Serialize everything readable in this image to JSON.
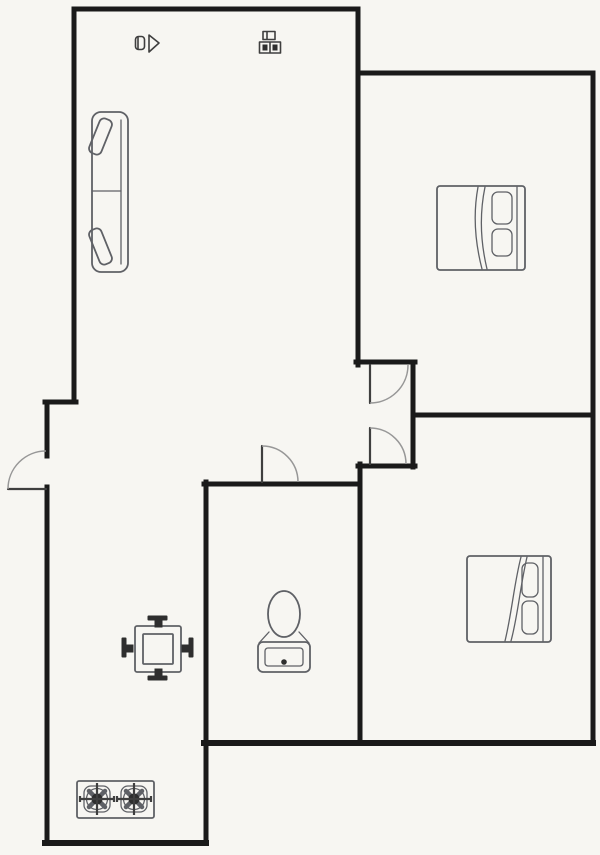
{
  "canvas": {
    "viewbox": "0 0 600 855",
    "width": "600",
    "height": "855"
  },
  "colors": {
    "background": "#f7f6f2",
    "wall": "#1a1a1a",
    "furniture": "#5f6166",
    "door-leaf": "#3f3f3f",
    "door-arc": "#979797",
    "dark-fill": "#2e2e2e"
  },
  "plan": {
    "type": "apartment-floor-plan",
    "icons": [
      "sofa-icon",
      "double-bed-icon",
      "double-bed-icon",
      "dining-table-icon",
      "toilet-icon",
      "gas-stove-icon",
      "entry-door-swing-icon",
      "bedroom-top-door-swing-icon",
      "bedroom-bottom-door-swing-icon",
      "bathroom-door-swing-icon",
      "plan-symbol-icon-1",
      "plan-symbol-icon-2"
    ]
  }
}
